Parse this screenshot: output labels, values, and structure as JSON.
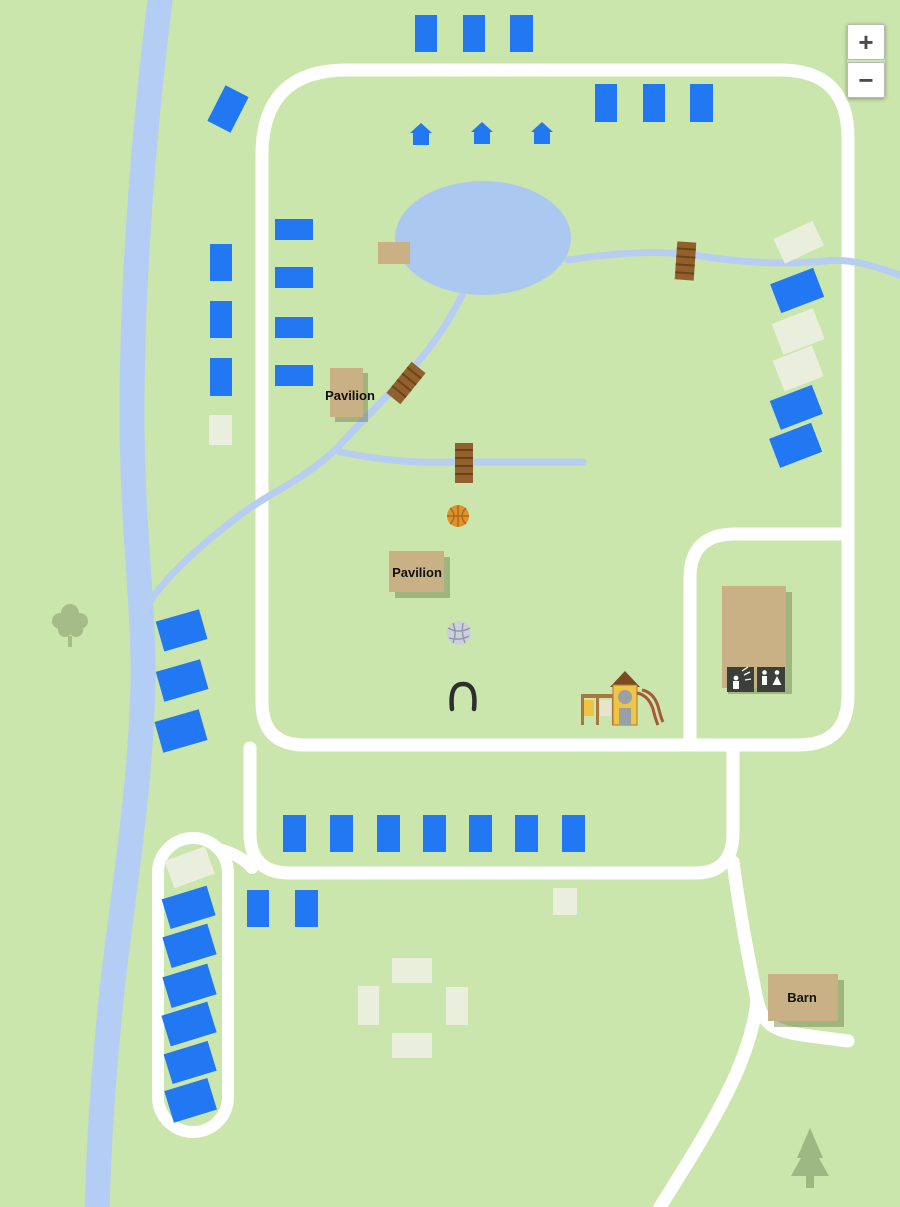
{
  "colors": {
    "background": "#cbe6ac",
    "road": "#ffffff",
    "river": "#b4cdf4",
    "stream": "#b7cef2",
    "pond": "#abc8f1",
    "campsite_blue": "#2277f3",
    "campsite_beige": "#e9eedd",
    "building": "#c9b185",
    "bridge": "#91602c",
    "label_text": "#111111"
  },
  "labels": {
    "pavilion_upper": "Pavilion",
    "pavilion_lower": "Pavilion",
    "barn": "Barn"
  },
  "zoom_controls": {
    "zoom_in_label": "+",
    "zoom_out_label": "−"
  }
}
